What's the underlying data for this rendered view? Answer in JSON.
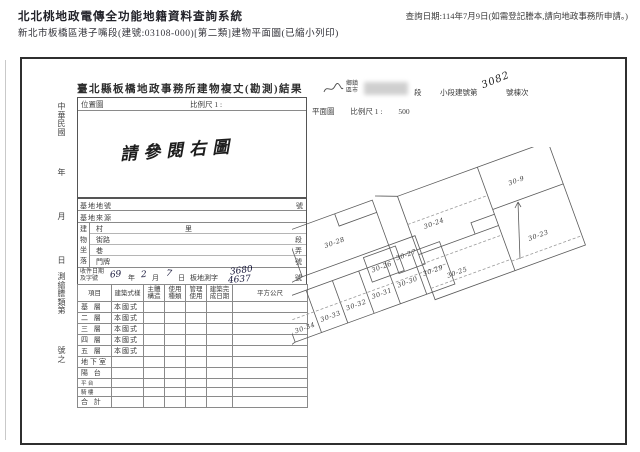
{
  "header": {
    "system_title": "北北桃地政電傳全功能地籍資料查詢系統",
    "query_date": "查詢日期:114年7月9日(如需登記謄本,請向地政事務所申請。)",
    "subtitle": "新北市板橋區港子嘴段(建號:03108-000)[第二類]建物平面圖(已縮小列印)"
  },
  "form": {
    "title": "臺北縣板橋地政事務所建物複丈(勘測)結果",
    "location_box": {
      "label": "位置圖",
      "scale_label": "比例尺 1 :",
      "note": "請參閱右圖"
    },
    "margin": {
      "era": "中華民國",
      "year_label": "年",
      "month_label": "月",
      "day_label": "日",
      "doc_label": "測繪謄類第",
      "doc_suffix": "號之"
    },
    "building_row": {
      "district_label": "鄉鎮區市",
      "section_label": "段",
      "subsection_label": "小段建號第",
      "building_no": "3082",
      "suffix_label": "號棟次"
    },
    "plan_row": {
      "label": "平面圖",
      "scale_label": "比例尺 1 :",
      "scale_value": "500"
    },
    "site": {
      "lot_label": "基地地號",
      "lot_no_suffix": "號",
      "source_label": "基地來源",
      "location_label": "建物坐落",
      "village_label": "村",
      "village_suffix": "里",
      "street_label": "街路",
      "street_suffix": "段",
      "lane_label": "巷",
      "lane_suffix": "弄",
      "door_label": "門牌",
      "door_suffix": "號"
    },
    "receipt": {
      "label_line1": "收件日期",
      "label_line2": "及字號",
      "year": "69",
      "year_unit": "年",
      "month": "2",
      "month_unit": "月",
      "day": "7",
      "day_unit": "日",
      "word_label": "板地測字",
      "no_top": "3680",
      "no_bottom": "4637",
      "no_suffix": "號"
    },
    "table": {
      "headers": [
        "項目",
        "建築式樣",
        "主體構造",
        "使用種類",
        "管理使用",
        "建築完成日期",
        "平方公尺"
      ],
      "rows": [
        {
          "floor": "基 層",
          "style": "本國式"
        },
        {
          "floor": "二 層",
          "style": "本國式"
        },
        {
          "floor": "三 層",
          "style": "本國式"
        },
        {
          "floor": "四 層",
          "style": "本國式"
        },
        {
          "floor": "五 層",
          "style": "本國式"
        },
        {
          "floor": "地下室",
          "style": ""
        },
        {
          "floor": "陽 台",
          "style": ""
        },
        {
          "floor": "平 台",
          "style": ""
        },
        {
          "floor": "騎 樓",
          "style": ""
        },
        {
          "floor": "合 計",
          "style": ""
        }
      ]
    }
  },
  "plan": {
    "parcels": {
      "p24": "30-24",
      "p9": "30-9",
      "p23": "30-23",
      "p25": "30-25",
      "p28": "30-28",
      "p26": "30-26",
      "p27": "30-27",
      "p29": "30-29",
      "p30": "30-30",
      "p31": "30-31",
      "p32": "30-32",
      "p33": "30-33",
      "p34": "30-34"
    }
  }
}
